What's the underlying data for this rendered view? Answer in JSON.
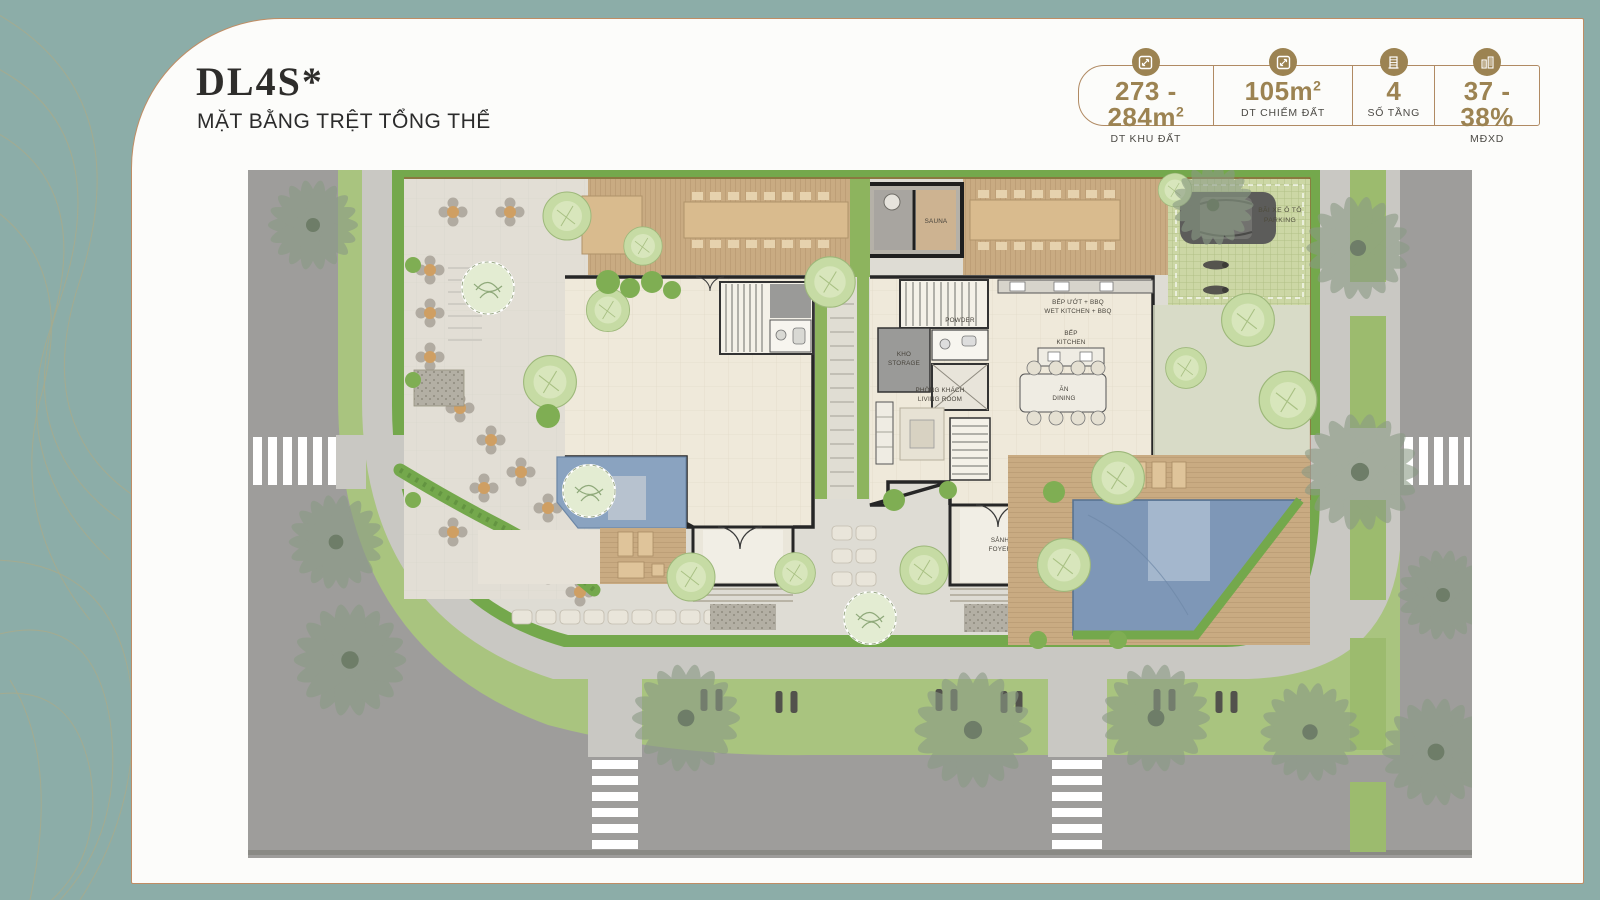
{
  "header": {
    "title": "DL4S*",
    "subtitle": "MẶT BẰNG TRỆT TỔNG THỂ"
  },
  "stats": {
    "items": [
      {
        "icon": "area-icon",
        "value": "273 - 284m",
        "sup": "2",
        "label": "DT KHU ĐẤT"
      },
      {
        "icon": "area-icon",
        "value": "105m",
        "sup": "2",
        "label": "DT CHIẾM ĐẤT"
      },
      {
        "icon": "floors-icon",
        "value": "4",
        "sup": "",
        "label": "SỐ TẦNG"
      },
      {
        "icon": "density-icon",
        "value": "37 - 38%",
        "sup": "",
        "label": "MĐXD"
      }
    ]
  },
  "plan": {
    "labels": {
      "sauna": "SAUNA",
      "parking_l1": "BÃI XE Ô TÔ",
      "parking_l2": "PARKING",
      "wet_l1": "BẾP ƯỚT + BBQ",
      "wet_l2": "WET KITCHEN + BBQ",
      "storage_l1": "KHO",
      "storage_l2": "STORAGE",
      "powder_l1": "POWDER",
      "powder_l2": "ROOM",
      "kitchen_l1": "BẾP",
      "kitchen_l2": "KITCHEN",
      "living_l1": "PHÒNG KHÁCH",
      "living_l2": "LIVING ROOM",
      "dining_l1": "ĂN",
      "dining_l2": "DINING",
      "foyer_l1": "SẢNH",
      "foyer_l2": "FOYER"
    }
  },
  "colors": {
    "teal_background": "#8cada8",
    "card_border_tan": "#c08d64",
    "accent_gold": "#9c8352",
    "hedge_green": "#74a84c",
    "pool_blue": "#7e97b7",
    "road_gray": "#9e9d9b"
  }
}
